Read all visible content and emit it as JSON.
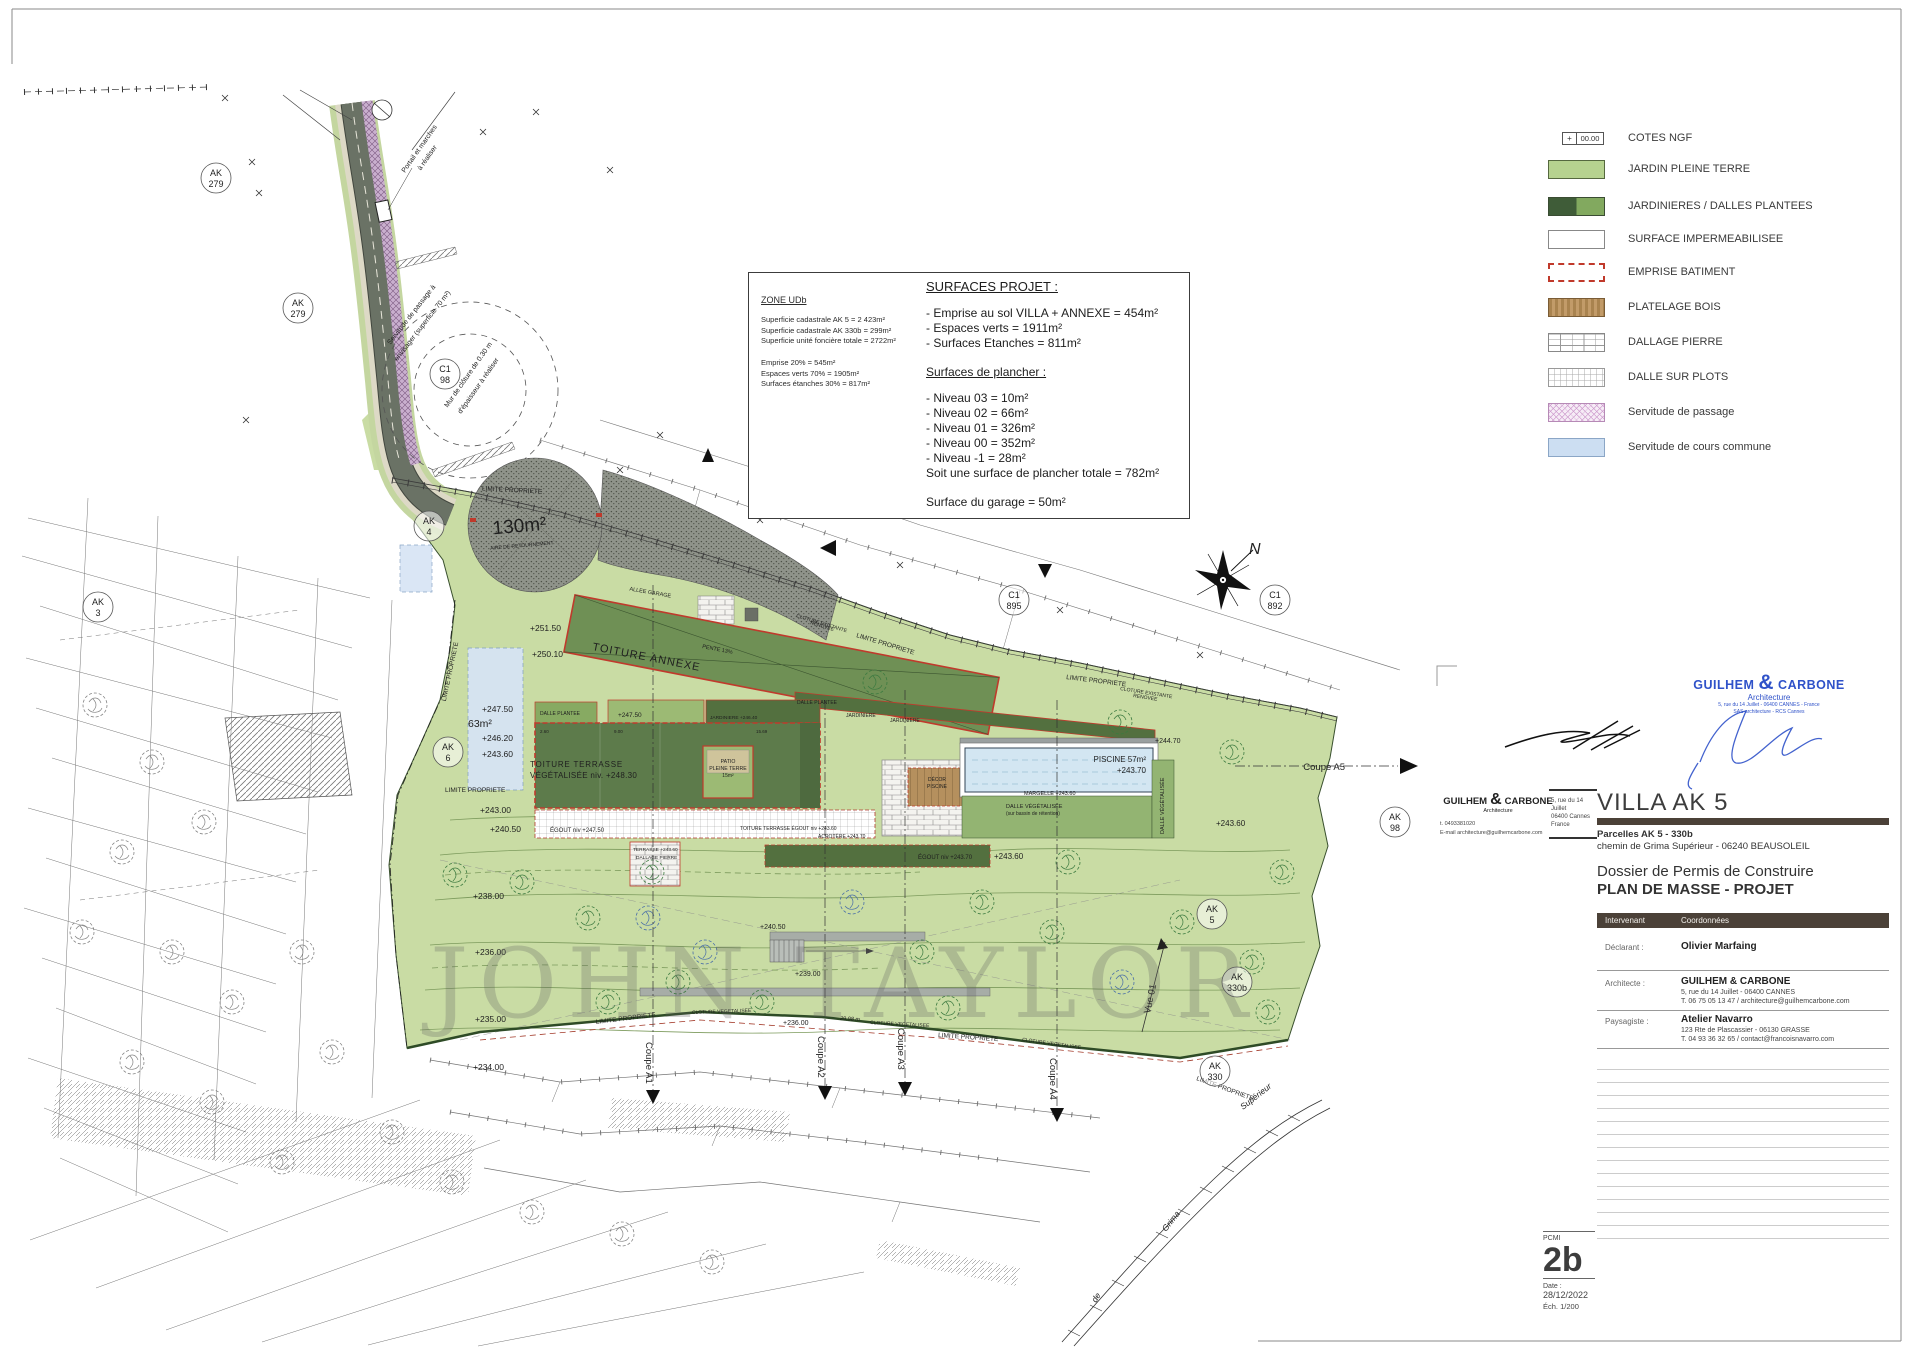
{
  "legend": {
    "cote_value": "00.00",
    "cote_plus": "+",
    "items": [
      {
        "label": "COTES NGF",
        "type": "cote"
      },
      {
        "label": "JARDIN PLEINE TERRE",
        "type": "jardin"
      },
      {
        "label": "JARDINIERES / DALLES PLANTEES",
        "type": "jardinieres"
      },
      {
        "label": "SURFACE IMPERMEABILISEE",
        "type": "impermeable"
      },
      {
        "label": "EMPRISE BATIMENT",
        "type": "emprise"
      },
      {
        "label": "PLATELAGE BOIS",
        "type": "bois"
      },
      {
        "label": "DALLAGE PIERRE",
        "type": "pierre"
      },
      {
        "label": "DALLE SUR PLOTS",
        "type": "plots"
      },
      {
        "label": "Servitude de passage",
        "type": "passage"
      },
      {
        "label": "Servitude de cours commune",
        "type": "cours"
      }
    ]
  },
  "info_box": {
    "zone": {
      "title": "ZONE UDb",
      "lines_a": [
        "Superficie cadastrale AK 5 = 2 423m²",
        "Superficie cadastrale AK 330b = 299m²",
        "Superficie unité foncière totale = 2722m²"
      ],
      "lines_b": [
        "Emprise 20% = 545m²",
        "Espaces verts 70% = 1905m²",
        "Surfaces étanches 30% = 817m²"
      ]
    },
    "surfaces": {
      "title": "SURFACES PROJET :",
      "lines_a": [
        "- Emprise au sol VILLA + ANNEXE = 454m²",
        "- Espaces verts = 1911m²",
        "- Surfaces Etanches = 811m²"
      ],
      "subtitle": "Surfaces de plancher :",
      "lines_b": [
        "- Niveau 03 = 10m²",
        "- Niveau 02 = 66m²",
        "- Niveau 01 = 326m²",
        "- Niveau 00 = 352m²",
        "- Niveau -1 = 28m²",
        "Soit une surface de plancher totale = 782m²"
      ],
      "garage": "Surface du garage = 50m²"
    }
  },
  "watermark": "JOHN TAYLOR",
  "title_block": {
    "project_title": "VILLA AK 5",
    "parcels": "Parcelles AK 5 - 330b",
    "address": "chemin de Grima Supérieur - 06240 BEAUSOLEIL",
    "dossier": "Dossier de Permis de Construire",
    "plan_name": "PLAN DE MASSE - PROJET",
    "stamp": {
      "name1": "GUILHEM",
      "amp": "&",
      "name2": "CARBONE",
      "sub": "Architecture",
      "small1": "5, rue du 14 Juillet - 06400 CANNES - France",
      "small2": "SAS architecture - RCS Cannes"
    },
    "firm": {
      "name1": "GUILHEM",
      "amp": "&",
      "name2": "CARBONE",
      "sub": "Architecture",
      "tel": "t. 0493381020",
      "email": "E-mail architecture@guilhemcarbone.com",
      "addr1": "5, rue du 14 Juillet",
      "addr2": "06400 Cannes",
      "addr3": "France"
    },
    "table": {
      "col1": "Intervenant",
      "col2": "Coordonnées",
      "rows": [
        {
          "role": "Déclarant :",
          "name": "Olivier Marfaing",
          "lines": [
            "",
            ""
          ]
        },
        {
          "role": "Architecte :",
          "name": "GUILHEM & CARBONE",
          "lines": [
            "5, rue du 14 Juillet - 06400 CANNES",
            "T. 06 75 05 13 47 / architecture@guilhemcarbone.com"
          ]
        },
        {
          "role": "Paysagiste :",
          "name": "Atelier Navarro",
          "lines": [
            "123 Rte de Plascassier - 06130 GRASSE",
            "T. 04 93 36 32 65 / contact@francoisnavarro.com"
          ]
        }
      ]
    },
    "page": {
      "code": "PCMI",
      "number": "2b",
      "date_label": "Date :",
      "date": "28/12/2022",
      "scale": "Éch. 1/200"
    }
  },
  "plan": {
    "labels": [
      {
        "t": "Portail et marches",
        "x": 421,
        "y": 150,
        "s": 7,
        "r": -55,
        "a": "middle"
      },
      {
        "t": "à réaliser",
        "x": 429,
        "y": 159,
        "s": 7,
        "r": -55,
        "a": "middle"
      },
      {
        "t": "Servitude de passage à",
        "x": 413,
        "y": 316,
        "s": 7,
        "r": -52,
        "a": "middle"
      },
      {
        "t": "envisager (superficie 70 m²)",
        "x": 424,
        "y": 327,
        "s": 7,
        "r": -52,
        "a": "middle"
      },
      {
        "t": "Mur de clôture de 0.30 m",
        "x": 470,
        "y": 376,
        "s": 7,
        "r": -55,
        "a": "middle"
      },
      {
        "t": "d'épaisseur à réaliser",
        "x": 480,
        "y": 387,
        "s": 7,
        "r": -55,
        "a": "middle"
      },
      {
        "t": "130m²",
        "x": 520,
        "y": 532,
        "s": 19,
        "r": -5,
        "a": "middle",
        "c": "#161616"
      },
      {
        "t": "AIRE DE RETOURNEMENT",
        "x": 522,
        "y": 547,
        "s": 5,
        "r": -5,
        "a": "middle",
        "c": "#333333"
      },
      {
        "t": "ALLEE GARAGE",
        "x": 650,
        "y": 594,
        "s": 5.5,
        "r": 10,
        "a": "middle"
      },
      {
        "t": "LIMITE PROPRIETE",
        "x": 512,
        "y": 492,
        "s": 6.5,
        "r": 3,
        "a": "middle"
      },
      {
        "t": "TOITURE ANNEXE",
        "x": 592,
        "y": 650,
        "s": 11,
        "r": 11,
        "ls": 1
      },
      {
        "t": "PENTE 13%",
        "x": 702,
        "y": 648,
        "s": 5.5,
        "r": 11
      },
      {
        "t": "+251.50",
        "x": 530,
        "y": 631,
        "s": 8.5
      },
      {
        "t": "+250.10",
        "x": 532,
        "y": 657,
        "s": 8.5
      },
      {
        "t": "+247.50",
        "x": 482,
        "y": 712,
        "s": 8.5
      },
      {
        "t": "63m²",
        "x": 468,
        "y": 727,
        "s": 10.5
      },
      {
        "t": "+246.20",
        "x": 482,
        "y": 741,
        "s": 8.5
      },
      {
        "t": "+243.60",
        "x": 482,
        "y": 757,
        "s": 8.5
      },
      {
        "t": "+243.00",
        "x": 480,
        "y": 813,
        "s": 8.5
      },
      {
        "t": "+240.50",
        "x": 490,
        "y": 832,
        "s": 8.5
      },
      {
        "t": "LIMITE PROPRIETE",
        "x": 445,
        "y": 792,
        "s": 6.5
      },
      {
        "t": "LIMITE PROPRIETE",
        "x": 452,
        "y": 672,
        "s": 6.5,
        "r": -78,
        "a": "middle"
      },
      {
        "t": "TOITURE TERRASSE",
        "x": 530,
        "y": 767,
        "s": 8,
        "ls": 0.8
      },
      {
        "t": "VÉGÉTALISÉE niv. +248.30",
        "x": 530,
        "y": 778,
        "s": 8,
        "ls": 0.3
      },
      {
        "t": "DALLE PLANTEE",
        "x": 540,
        "y": 715,
        "s": 5
      },
      {
        "t": "+247.50",
        "x": 618,
        "y": 717,
        "s": 6.5
      },
      {
        "t": "JARDINIERE +246.40",
        "x": 710,
        "y": 719,
        "s": 4.8
      },
      {
        "t": "2.60",
        "x": 540,
        "y": 733,
        "s": 4.5,
        "c": "#444444"
      },
      {
        "t": "9.00",
        "x": 614,
        "y": 733,
        "s": 4.5,
        "c": "#444444"
      },
      {
        "t": "15.69",
        "x": 756,
        "y": 733,
        "s": 4.5,
        "c": "#444444"
      },
      {
        "t": "PATIO",
        "x": 728,
        "y": 763,
        "s": 5.2,
        "a": "middle"
      },
      {
        "t": "PLEINE TERRE",
        "x": 728,
        "y": 770,
        "s": 5.2,
        "a": "middle"
      },
      {
        "t": "15m²",
        "x": 728,
        "y": 777,
        "s": 5,
        "a": "middle"
      },
      {
        "t": "ÉGOUT niv +247.50",
        "x": 550,
        "y": 832,
        "s": 6
      },
      {
        "t": "TOITURE TERRASSE ÉGOUT niv +243.60",
        "x": 740,
        "y": 830,
        "s": 5
      },
      {
        "t": "ACROTÈRE +243.70",
        "x": 818,
        "y": 838,
        "s": 5
      },
      {
        "t": "TERRASSE +243.60",
        "x": 633,
        "y": 851,
        "s": 4.8
      },
      {
        "t": "DALLAGE PIERRE",
        "x": 636,
        "y": 859,
        "s": 4.8
      },
      {
        "t": "ÉGOUT niv +243.70",
        "x": 918,
        "y": 859,
        "s": 6
      },
      {
        "t": "+243.60",
        "x": 994,
        "y": 859,
        "s": 8
      },
      {
        "t": "DALLE PLANTEE",
        "x": 797,
        "y": 704,
        "s": 5
      },
      {
        "t": "JARDINIERE",
        "x": 846,
        "y": 717,
        "s": 5
      },
      {
        "t": "JARDINIERE",
        "x": 890,
        "y": 722,
        "s": 5
      },
      {
        "t": "DÉCOR",
        "x": 937,
        "y": 781,
        "s": 5,
        "a": "middle"
      },
      {
        "t": "PISCINE",
        "x": 937,
        "y": 788,
        "s": 5,
        "a": "middle"
      },
      {
        "t": "PISCINE 57m²",
        "x": 1146,
        "y": 762,
        "s": 8,
        "a": "end"
      },
      {
        "t": "+243.70",
        "x": 1146,
        "y": 773,
        "s": 8,
        "a": "end"
      },
      {
        "t": "MARGELLE +243.60",
        "x": 1024,
        "y": 795,
        "s": 5.5
      },
      {
        "t": "DALLE VÉGÉTALISÉE",
        "x": 1006,
        "y": 808,
        "s": 5.5
      },
      {
        "t": "(sur bassin de rétention)",
        "x": 1006,
        "y": 815,
        "s": 5
      },
      {
        "t": "DALLE VÉGÉTALISÉE",
        "x": 1164,
        "y": 834,
        "s": 5.5,
        "r": -90
      },
      {
        "t": "+244.70",
        "x": 1155,
        "y": 743,
        "s": 7
      },
      {
        "t": "+243.60",
        "x": 1216,
        "y": 826,
        "s": 8
      },
      {
        "t": "LIMITE PROPRIETE",
        "x": 856,
        "y": 637,
        "s": 6.5,
        "r": 17
      },
      {
        "t": "CLOTURE EXISTANTE",
        "x": 796,
        "y": 617,
        "s": 5,
        "r": 17
      },
      {
        "t": "RENOVEE",
        "x": 810,
        "y": 624,
        "s": 5,
        "r": 17
      },
      {
        "t": "LIMITE PROPRIETE",
        "x": 1066,
        "y": 679,
        "s": 6.5,
        "r": 7
      },
      {
        "t": "CLOTURE EXISTANTE",
        "x": 1120,
        "y": 690,
        "s": 5,
        "r": 9
      },
      {
        "t": "RENOVEE",
        "x": 1133,
        "y": 697,
        "s": 5,
        "r": 9
      },
      {
        "t": "+238.00",
        "x": 473,
        "y": 899,
        "s": 8.5
      },
      {
        "t": "+236.00",
        "x": 475,
        "y": 955,
        "s": 8.5
      },
      {
        "t": "+235.00",
        "x": 475,
        "y": 1022,
        "s": 8.5
      },
      {
        "t": "+234.00",
        "x": 473,
        "y": 1070,
        "s": 8.5
      },
      {
        "t": "+240.50",
        "x": 760,
        "y": 929,
        "s": 7
      },
      {
        "t": "+239.00",
        "x": 795,
        "y": 976,
        "s": 7
      },
      {
        "t": "+236.00",
        "x": 783,
        "y": 1025,
        "s": 7
      },
      {
        "t": "LIMITE PROPRIETE",
        "x": 596,
        "y": 1024,
        "s": 6.5,
        "r": -7
      },
      {
        "t": "CLOTURE VEGETALISEE",
        "x": 692,
        "y": 1014,
        "s": 5,
        "r": -2
      },
      {
        "t": "29.98 m",
        "x": 840,
        "y": 1020,
        "s": 5.5,
        "r": 3,
        "i": 1
      },
      {
        "t": "CLOTURE VEGETALISEE",
        "x": 870,
        "y": 1024,
        "s": 5,
        "r": 3
      },
      {
        "t": "LIMITE PROPRIETE",
        "x": 938,
        "y": 1037,
        "s": 6.5,
        "r": 4
      },
      {
        "t": "CLOTURE VEGETALISEE",
        "x": 1022,
        "y": 1041,
        "s": 5,
        "r": 8
      },
      {
        "t": "LIMITE PROPRIETE",
        "x": 1196,
        "y": 1080,
        "s": 6.5,
        "r": 20
      },
      {
        "t": "Coupe A1",
        "x": 646,
        "y": 1042,
        "s": 9.5,
        "r": 90
      },
      {
        "t": "Coupe A2",
        "x": 818,
        "y": 1036,
        "s": 9.5,
        "r": 90
      },
      {
        "t": "Coupe A3",
        "x": 898,
        "y": 1028,
        "s": 9.5,
        "r": 90
      },
      {
        "t": "Coupe A4",
        "x": 1050,
        "y": 1058,
        "s": 9.5,
        "r": 90
      },
      {
        "t": "Coupe A5",
        "x": 1345,
        "y": 770,
        "s": 9.5,
        "a": "end"
      },
      {
        "t": "Vue 01",
        "x": 1150,
        "y": 1014,
        "s": 9.5,
        "r": -78
      },
      {
        "t": "N",
        "x": 1249,
        "y": 554,
        "s": 16,
        "i": 1,
        "f": 1
      },
      {
        "t": "Supérieur",
        "x": 1243,
        "y": 1110,
        "s": 8.5,
        "r": -38,
        "i": 1,
        "f": 1
      },
      {
        "t": "Grima",
        "x": 1166,
        "y": 1232,
        "s": 8.5,
        "r": -52,
        "i": 1,
        "f": 1
      },
      {
        "t": "de",
        "x": 1096,
        "y": 1303,
        "s": 8.5,
        "r": -58,
        "i": 1,
        "f": 1
      }
    ],
    "parcel_markers": [
      {
        "a": "AK",
        "b": "279",
        "x": 216,
        "y": 178
      },
      {
        "a": "AK",
        "b": "279",
        "x": 298,
        "y": 308
      },
      {
        "a": "C1",
        "b": "98",
        "x": 445,
        "y": 374
      },
      {
        "a": "AK",
        "b": "4",
        "x": 429,
        "y": 526
      },
      {
        "a": "AK",
        "b": "3",
        "x": 98,
        "y": 607
      },
      {
        "a": "AK",
        "b": "6",
        "x": 448,
        "y": 752
      },
      {
        "a": "C1",
        "b": "895",
        "x": 1014,
        "y": 600
      },
      {
        "a": "C1",
        "b": "892",
        "x": 1275,
        "y": 600
      },
      {
        "a": "AK",
        "b": "98",
        "x": 1395,
        "y": 822
      },
      {
        "a": "AK",
        "b": "5",
        "x": 1212,
        "y": 914
      },
      {
        "a": "AK",
        "b": "330b",
        "x": 1237,
        "y": 982
      },
      {
        "a": "AK",
        "b": "330",
        "x": 1215,
        "y": 1071
      }
    ]
  }
}
